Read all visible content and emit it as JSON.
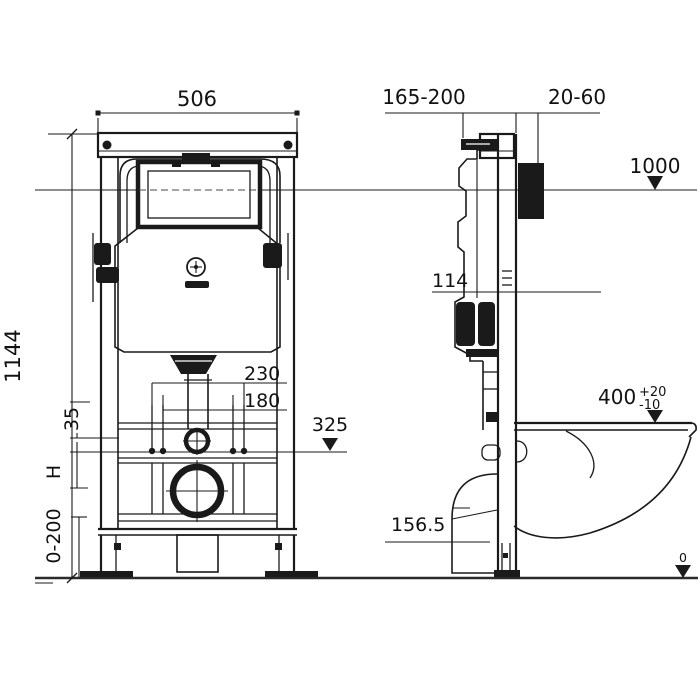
{
  "colors": {
    "ink": "#1a1a1a",
    "background": "#ffffff",
    "level_line": "#4a4a4a"
  },
  "front_view": {
    "frame_width": "506",
    "frame_height": "1144",
    "outlet_spacing_outer": "230",
    "fixing_bolt_spacing": "180",
    "bracket_offset": "35",
    "fixing_bolt_height": "325",
    "height_symbol": "H",
    "foot_adjustment_range": "0-200"
  },
  "side_view": {
    "water_supply_range": "165-200",
    "wall_finish_range": "20-60",
    "control_panel_level": "1000",
    "inlet_dimension": "114",
    "outlet_height": "156.5",
    "bowl_top_height": "400",
    "bowl_tolerance_plus": "+20",
    "bowl_tolerance_minus": "-10",
    "floor_level": "0"
  }
}
